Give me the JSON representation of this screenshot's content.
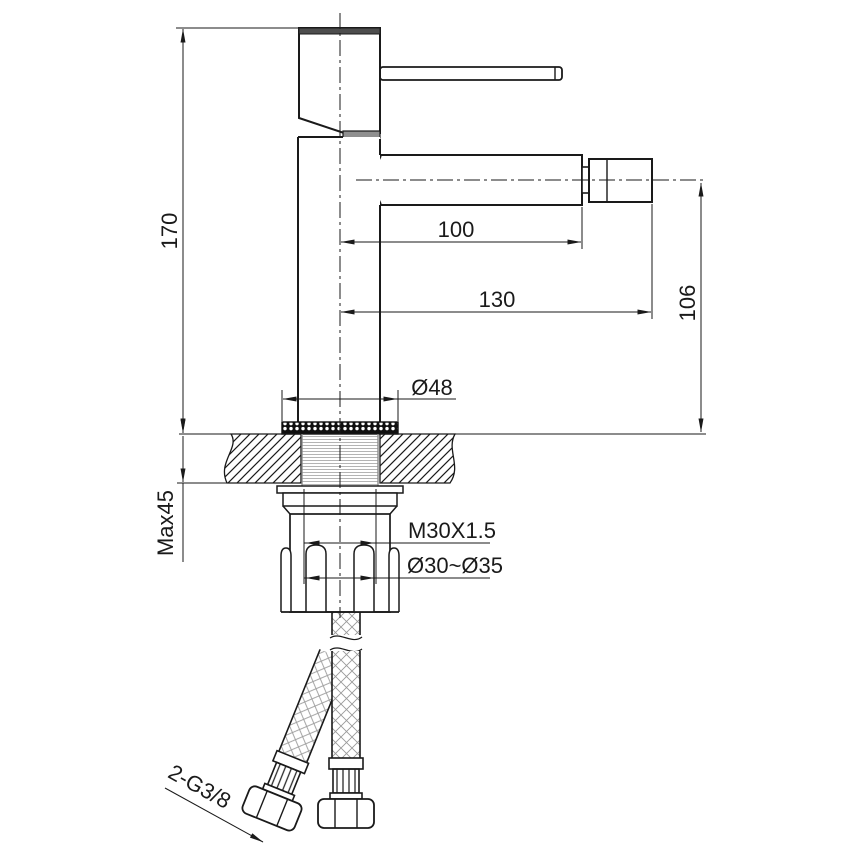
{
  "labels": {
    "overall_height": "170",
    "spout_reach": "100",
    "overall_reach": "130",
    "spout_height": "106",
    "base_diameter": "Ø48",
    "max_deck_thickness": "Max45",
    "mounting_thread": "M30X1.5",
    "mounting_hole_diameter": "Ø30~Ø35",
    "hose_connection": "2-G3/8"
  }
}
